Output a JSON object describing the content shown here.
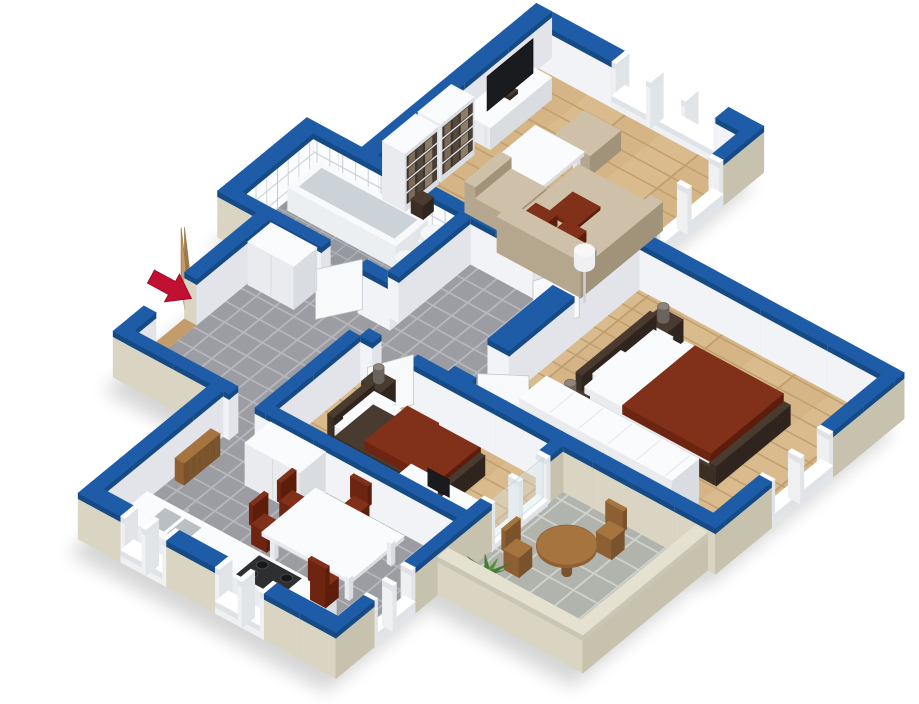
{
  "scene": {
    "title": "3D isometric apartment floor plan render",
    "type": "floorplan-3d-render",
    "background": "#ffffff"
  },
  "colors": {
    "wall_top_blue": "#1e5ca8",
    "wall_top_edge": "#154a84",
    "wall_white_sw": "#f2f3f6",
    "wall_white_se": "#e2e4ea",
    "wall_beige_sw": "#d9d5c2",
    "wall_beige_se": "#c6c2ad",
    "parapet_top": "#e4e1d1",
    "parapet_edge": "#c9c6b4",
    "floor_wood": "#d9bb8d",
    "floor_wood_line": "#c19e6e",
    "floor_tile": "#9b9da2",
    "floor_tile_grout": "#b6b8bd",
    "floor_tile_bath": "#96989f",
    "floor_tile_bath_grout": "#aeb0b7",
    "floor_tile_balcony": "#b1b3ad",
    "floor_tile_balcony_grout": "#cfd1cb",
    "wall_tile": "#fbfcfd",
    "wall_tile_grout": "#ccd1d7",
    "furn_white_top": "#fafbfc",
    "furn_white_sw": "#e9ebee",
    "furn_white_se": "#d9dce1",
    "furn_dark_top": "#4a3b30",
    "furn_dark_sw": "#3a2e25",
    "furn_dark_se": "#2f251e",
    "bedding_top": "#81301a",
    "bedding_sw": "#6d2410",
    "bedding_se": "#5c1d0b",
    "sofa_top": "#cfc1a9",
    "sofa_sw": "#b5a78d",
    "sofa_se": "#a1937a",
    "wood_top": "#a5743f",
    "wood_sw": "#8d5f33",
    "wood_se": "#7a522c",
    "door_wood": "#c49b6a",
    "door_wood_edge": "#9e7848",
    "door_white": "#f8f9fa",
    "door_white_edge": "#bcc1c7",
    "window_frame": "#f4f6f7",
    "glass": "#d8e4ea",
    "tv_dark": "#1a1b1e",
    "metal_gray": "#b3babe",
    "lamp_dark": "#6b645c",
    "lamp_white": "#f0f0f2",
    "plant_green": "#55903c",
    "plant_green_dark": "#477c31",
    "arrow_red": "#c11031",
    "shadow": "#000000"
  },
  "rooms": [
    {
      "id": "living-room",
      "name": "Living room",
      "floor": "wood",
      "furniture": [
        "tv-stand",
        "tv",
        "bookshelf",
        "bookshelf",
        "media-unit",
        "sofa",
        "armchair",
        "ottoman",
        "coffee-table",
        "floor-lamp"
      ],
      "windows": 2
    },
    {
      "id": "master-bedroom",
      "name": "Master bedroom",
      "floor": "wood",
      "furniture": [
        "double-bed",
        "nightstand",
        "nightstand",
        "table-lamp",
        "table-lamp",
        "wardrobe"
      ],
      "windows": 1
    },
    {
      "id": "second-bedroom",
      "name": "Second bedroom",
      "floor": "wood",
      "furniture": [
        "single-bed",
        "nightstand",
        "table-lamp",
        "desk",
        "monitor"
      ],
      "windows": 1
    },
    {
      "id": "kitchen",
      "name": "Kitchen",
      "floor": "tile",
      "furniture": [
        "kitchen-counter",
        "sink",
        "stove",
        "tall-cabinet",
        "radiator",
        "dining-table",
        "chair",
        "chair",
        "chair",
        "chair"
      ],
      "windows": 3
    },
    {
      "id": "bathroom",
      "name": "Bathroom",
      "floor": "tile",
      "furniture": [
        "bathtub",
        "washbasin",
        "toilet"
      ],
      "windows": 0
    },
    {
      "id": "hallway",
      "name": "Hallway",
      "floor": "tile",
      "furniture": [
        "wardrobe-row"
      ],
      "windows": 0
    },
    {
      "id": "balcony",
      "name": "Balcony",
      "floor": "tile",
      "furniture": [
        "round-table",
        "garden-chair",
        "garden-chair",
        "potted-plant"
      ],
      "windows": 0
    }
  ],
  "entrance": {
    "marker": "red-arrow",
    "door": "open-wooden-door",
    "location": "south-west wall"
  }
}
